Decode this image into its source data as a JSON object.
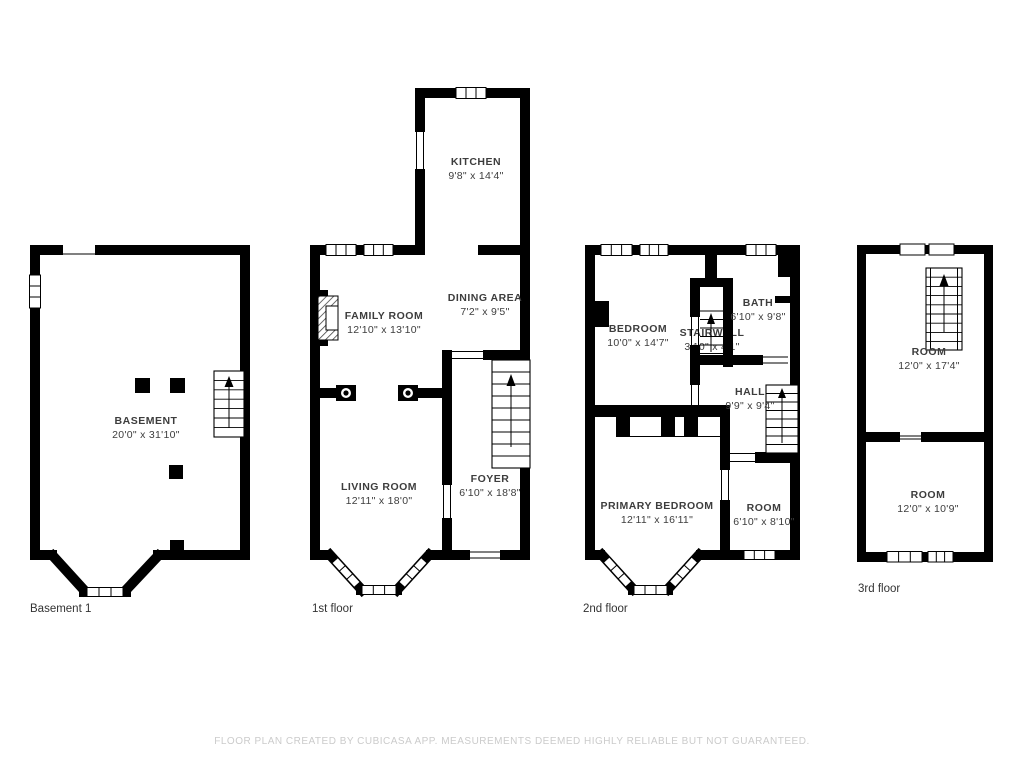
{
  "colors": {
    "wall": "#000000",
    "room_text": "#3d3d3d",
    "floor_label_text": "#333333",
    "disclaimer_text": "#cbcbcb",
    "background": "#ffffff"
  },
  "floors": [
    {
      "id": "basement",
      "label": "Basement 1",
      "rooms": [
        {
          "name": "BASEMENT",
          "dims": "20'0\" x 31'10\""
        }
      ]
    },
    {
      "id": "first",
      "label": "1st floor",
      "rooms": [
        {
          "name": "KITCHEN",
          "dims": "9'8\" x 14'4\""
        },
        {
          "name": "DINING AREA",
          "dims": "7'2\" x 9'5\""
        },
        {
          "name": "FAMILY ROOM",
          "dims": "12'10\" x 13'10\""
        },
        {
          "name": "LIVING ROOM",
          "dims": "12'11\" x 18'0\""
        },
        {
          "name": "FOYER",
          "dims": "6'10\" x 18'8\""
        }
      ]
    },
    {
      "id": "second",
      "label": "2nd floor",
      "rooms": [
        {
          "name": "BEDROOM",
          "dims": "10'0\" x 14'7\""
        },
        {
          "name": "BATH",
          "dims": "6'10\" x 9'8\""
        },
        {
          "name": "STAIRWELL",
          "dims": "3'10\" x 4'1\""
        },
        {
          "name": "HALL",
          "dims": "9'9\" x 9'4\""
        },
        {
          "name": "PRIMARY BEDROOM",
          "dims": "12'11\" x 16'11\""
        },
        {
          "name": "ROOM",
          "dims": "6'10\" x 8'10\""
        }
      ]
    },
    {
      "id": "third",
      "label": "3rd floor",
      "rooms": [
        {
          "name": "ROOM",
          "dims": "12'0\" x 17'4\""
        },
        {
          "name": "ROOM",
          "dims": "12'0\" x 10'9\""
        }
      ]
    }
  ],
  "footer": {
    "disclaimer": "FLOOR PLAN CREATED BY CUBICASA APP. MEASUREMENTS DEEMED HIGHLY RELIABLE BUT NOT GUARANTEED."
  }
}
